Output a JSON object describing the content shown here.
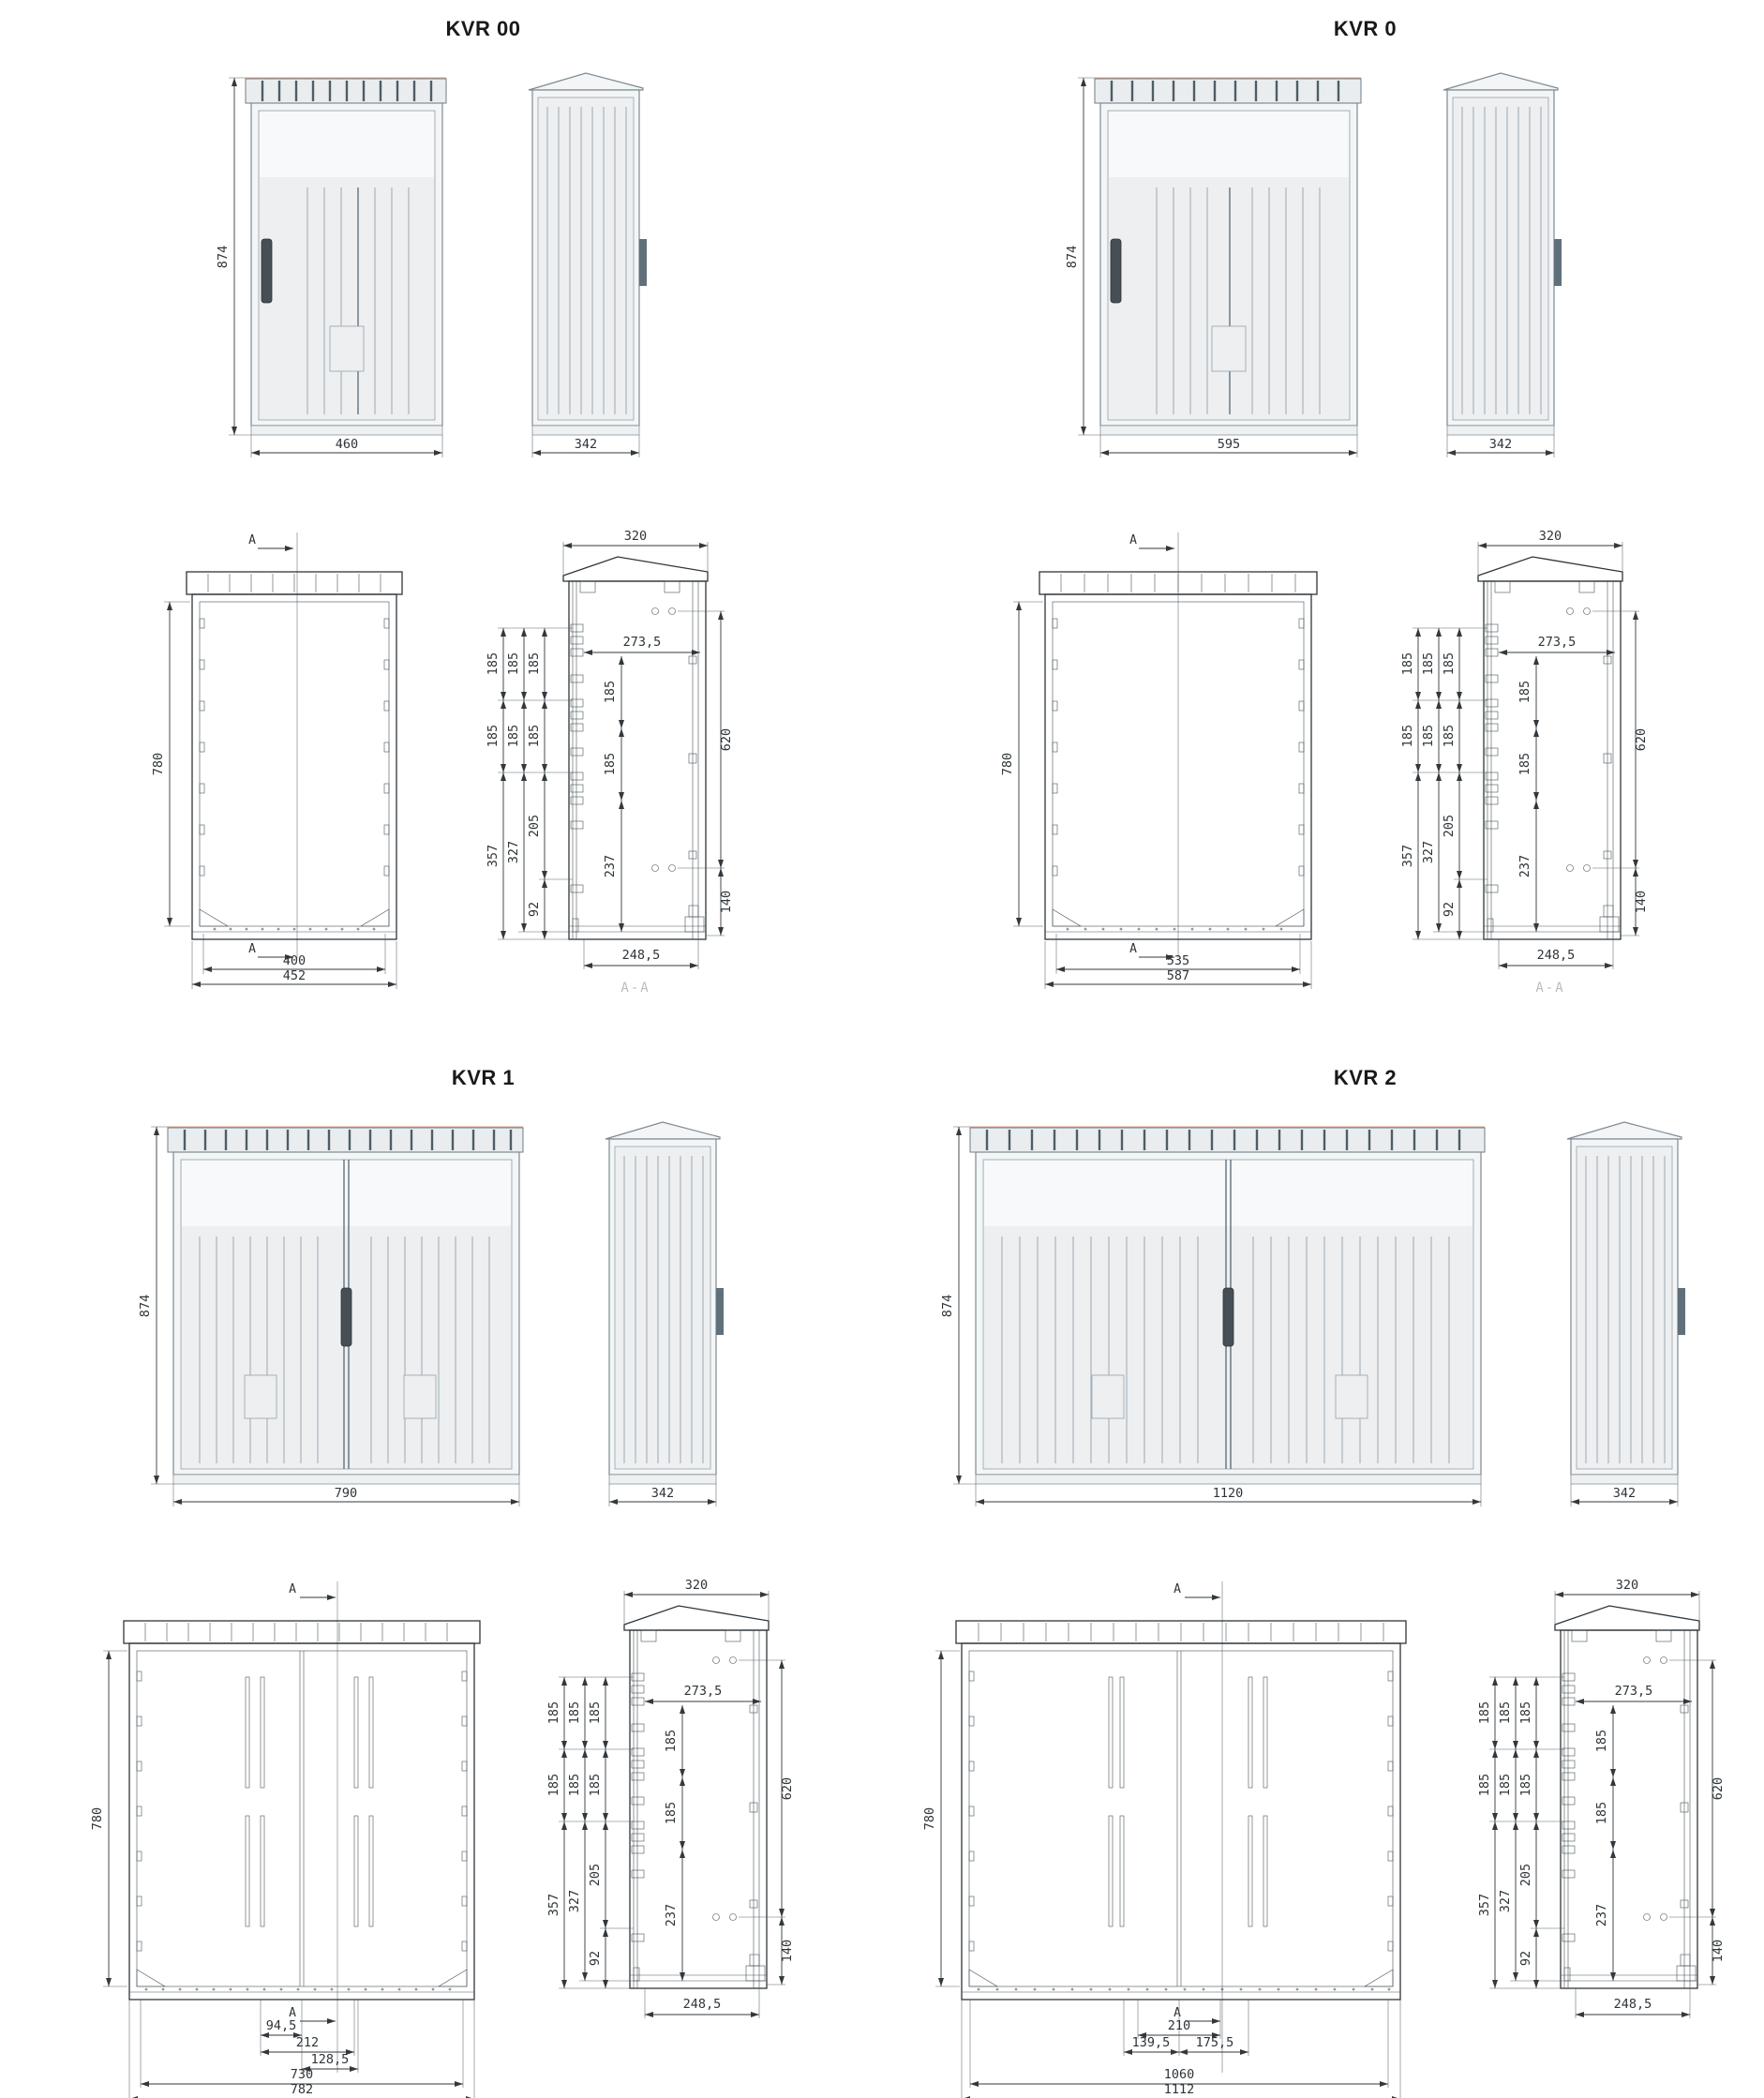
{
  "titles": {
    "kvr00": "KVR 00",
    "kvr0": "KVR 0",
    "kvr1": "KVR 1",
    "kvr2": "KVR 2"
  },
  "render": {
    "height": "874",
    "side_width": "342",
    "front_width": {
      "kvr00": "460",
      "kvr0": "595",
      "kvr1": "790",
      "kvr2": "1120"
    }
  },
  "front": {
    "height": "780",
    "mark": "A",
    "kvr00": {
      "inner": "400",
      "outer": "452"
    },
    "kvr0": {
      "inner": "535",
      "outer": "587"
    },
    "kvr1": {
      "d1": "94,5",
      "d2": "212",
      "d3": "128,5",
      "inner": "730",
      "outer": "782"
    },
    "kvr2": {
      "d1": "210",
      "d2": "139,5",
      "d3": "175,5",
      "inner": "1060",
      "outer": "1112"
    }
  },
  "side": {
    "top_width": "320",
    "depth": "273,5",
    "pitch": "185",
    "s357": "357",
    "s327": "327",
    "s205": "205",
    "s92": "92",
    "s237": "237",
    "s620": "620",
    "s140": "140",
    "bottom": "248,5",
    "section_label": "A-A"
  }
}
